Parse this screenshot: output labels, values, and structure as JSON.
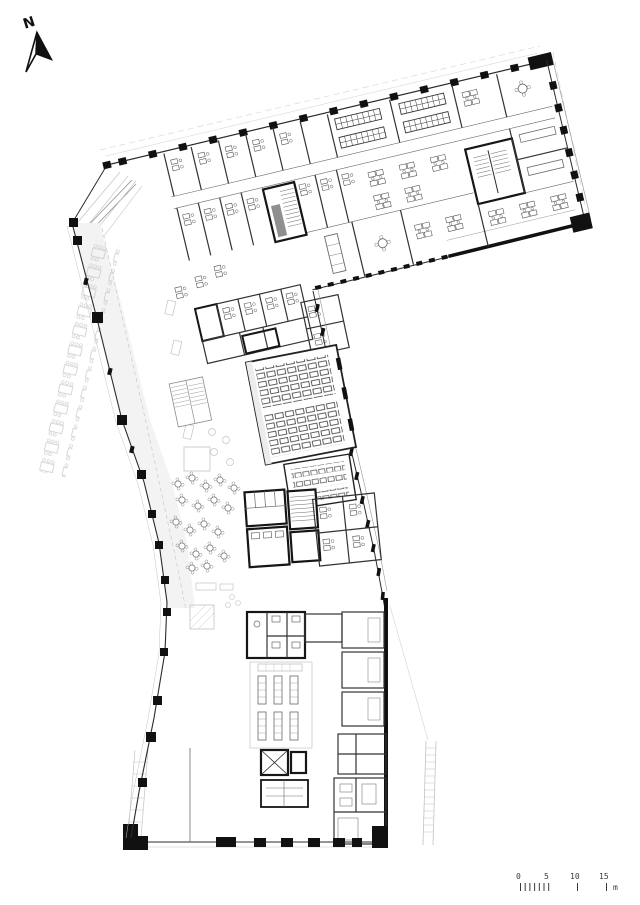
{
  "north_arrow": {
    "label": "N"
  },
  "scale_bar": {
    "tick_labels": [
      "0",
      "5",
      "10",
      "15"
    ],
    "unit_label": "m"
  },
  "drawing": {
    "background": "#ffffff",
    "ink": "#2b2b2b",
    "column_fill": "#111111",
    "faint_line": "#c3c3c3",
    "shade_fill": "#f2f2f2",
    "elevator_fill": "#8f8f8f"
  }
}
